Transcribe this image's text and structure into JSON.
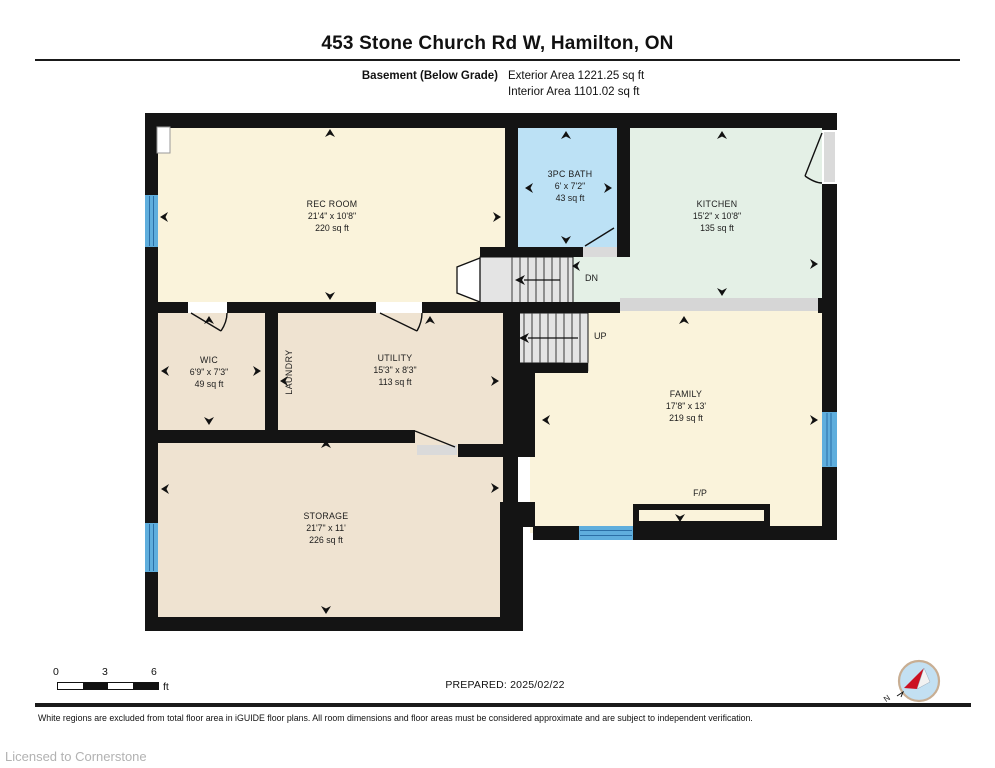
{
  "header": {
    "title": "453 Stone Church Rd W, Hamilton, ON",
    "floor_label": "Basement (Below Grade)",
    "exterior_area": "Exterior Area 1221.25 sq ft",
    "interior_area": "Interior Area 1101.02 sq ft"
  },
  "rooms": [
    {
      "name": "REC ROOM",
      "dims": "21'4\" x 10'8\"",
      "area": "220 sq ft"
    },
    {
      "name": "3PC BATH",
      "dims": "6' x 7'2\"",
      "area": "43 sq ft"
    },
    {
      "name": "KITCHEN",
      "dims": "15'2\" x 10'8\"",
      "area": "135 sq ft"
    },
    {
      "name": "WIC",
      "dims": "6'9\" x 7'3\"",
      "area": "49 sq ft"
    },
    {
      "name": "UTILITY",
      "dims": "15'3\" x 8'3\"",
      "area": "113 sq ft"
    },
    {
      "name": "FAMILY",
      "dims": "17'8\" x 13'",
      "area": "219 sq ft"
    },
    {
      "name": "STORAGE",
      "dims": "21'7\" x 11'",
      "area": "226 sq ft"
    }
  ],
  "plan_labels": {
    "laundry": "LAUNDRY",
    "down": "DN",
    "up": "UP",
    "fireplace": "F/P"
  },
  "scale_bar": {
    "ticks": [
      "0",
      "3",
      "6"
    ],
    "unit": "ft"
  },
  "compass": {
    "north_label": "N"
  },
  "footer": {
    "prepared": "PREPARED: 2025/02/22",
    "disclaimer": "White regions are excluded from total floor area in iGUIDE floor plans. All room dimensions and floor areas must be considered approximate and are subject to independent verification.",
    "license": "Licensed to Cornerstone"
  },
  "colors": {
    "cream": "#FAF3DB",
    "tan": "#EFE3D1",
    "bath_blue": "#BCE1F5",
    "kitchen_green": "#E4F0E6",
    "window_blue": "#5FAEDD",
    "window_line": "#2B6FA6",
    "wall": "#141414",
    "stair_gray": "#E4E4E4",
    "bulkhead_gray": "#D6D6D6",
    "door_gray": "#DADADA"
  }
}
